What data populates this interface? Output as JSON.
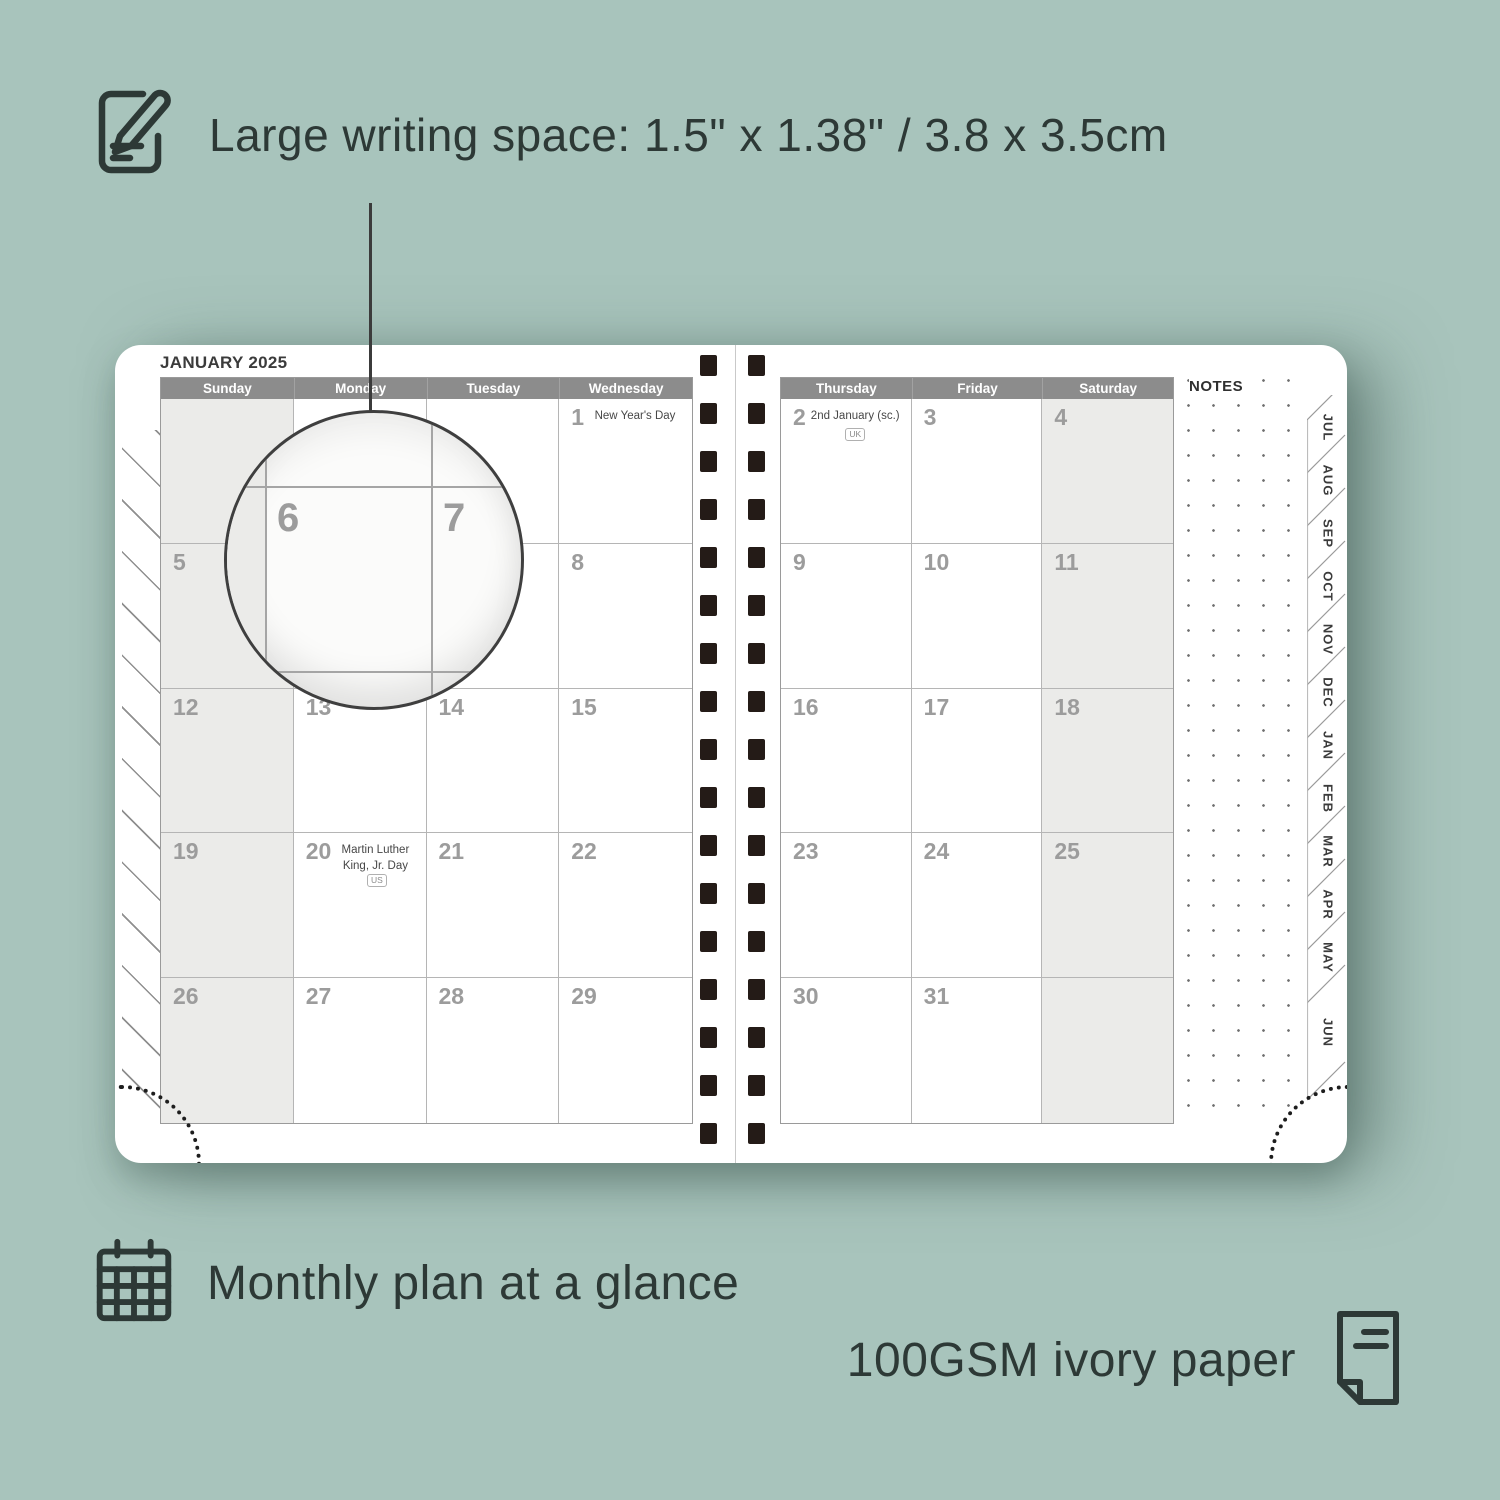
{
  "colors": {
    "background": "#a8c4bc",
    "feature_text": "#2d3936",
    "calendar_header_bar": "#8c8c8c",
    "shaded_column": "#ebebe9",
    "spiral_holes": "#241b17",
    "date_number": "#9c9c9c"
  },
  "features": {
    "top": {
      "icon": "notepad-pencil-icon",
      "label": "Large writing space: 1.5\" x 1.38\" / 3.8 x 3.5cm"
    },
    "bottom_left": {
      "icon": "calendar-grid-icon",
      "label": "Monthly plan at a glance"
    },
    "bottom_right": {
      "icon": "paper-sheet-icon",
      "label": "100GSM ivory paper"
    }
  },
  "planner": {
    "title": "JANUARY 2025",
    "notes_label": "NOTES",
    "magnifier": {
      "left_date": "6",
      "right_date": "7"
    },
    "tabs": [
      "JUL",
      "AUG",
      "SEP",
      "OCT",
      "NOV",
      "DEC",
      "JAN",
      "FEB",
      "MAR",
      "APR",
      "MAY",
      "JUN"
    ],
    "left_page": {
      "day_headers": [
        "Sunday",
        "Monday",
        "Tuesday",
        "Wednesday"
      ],
      "rows": [
        [
          {
            "date": ""
          },
          {
            "date": ""
          },
          {
            "date": ""
          },
          {
            "date": "1",
            "holiday": "New Year's Day"
          }
        ],
        [
          {
            "date": "5"
          },
          {
            "date": "6"
          },
          {
            "date": "7"
          },
          {
            "date": "8"
          }
        ],
        [
          {
            "date": "12"
          },
          {
            "date": "13"
          },
          {
            "date": "14"
          },
          {
            "date": "15"
          }
        ],
        [
          {
            "date": "19"
          },
          {
            "date": "20",
            "holiday": "Martin Luther King, Jr. Day",
            "badge": "US"
          },
          {
            "date": "21"
          },
          {
            "date": "22"
          }
        ],
        [
          {
            "date": "26"
          },
          {
            "date": "27"
          },
          {
            "date": "28"
          },
          {
            "date": "29"
          }
        ]
      ]
    },
    "right_page": {
      "day_headers": [
        "Thursday",
        "Friday",
        "Saturday"
      ],
      "rows": [
        [
          {
            "date": "2",
            "holiday": "2nd January (sc.)",
            "badge": "UK",
            "badge_below": true
          },
          {
            "date": "3"
          },
          {
            "date": "4"
          }
        ],
        [
          {
            "date": "9"
          },
          {
            "date": "10"
          },
          {
            "date": "11"
          }
        ],
        [
          {
            "date": "16"
          },
          {
            "date": "17"
          },
          {
            "date": "18"
          }
        ],
        [
          {
            "date": "23"
          },
          {
            "date": "24"
          },
          {
            "date": "25"
          }
        ],
        [
          {
            "date": "30"
          },
          {
            "date": "31"
          },
          {
            "date": ""
          }
        ]
      ]
    }
  }
}
